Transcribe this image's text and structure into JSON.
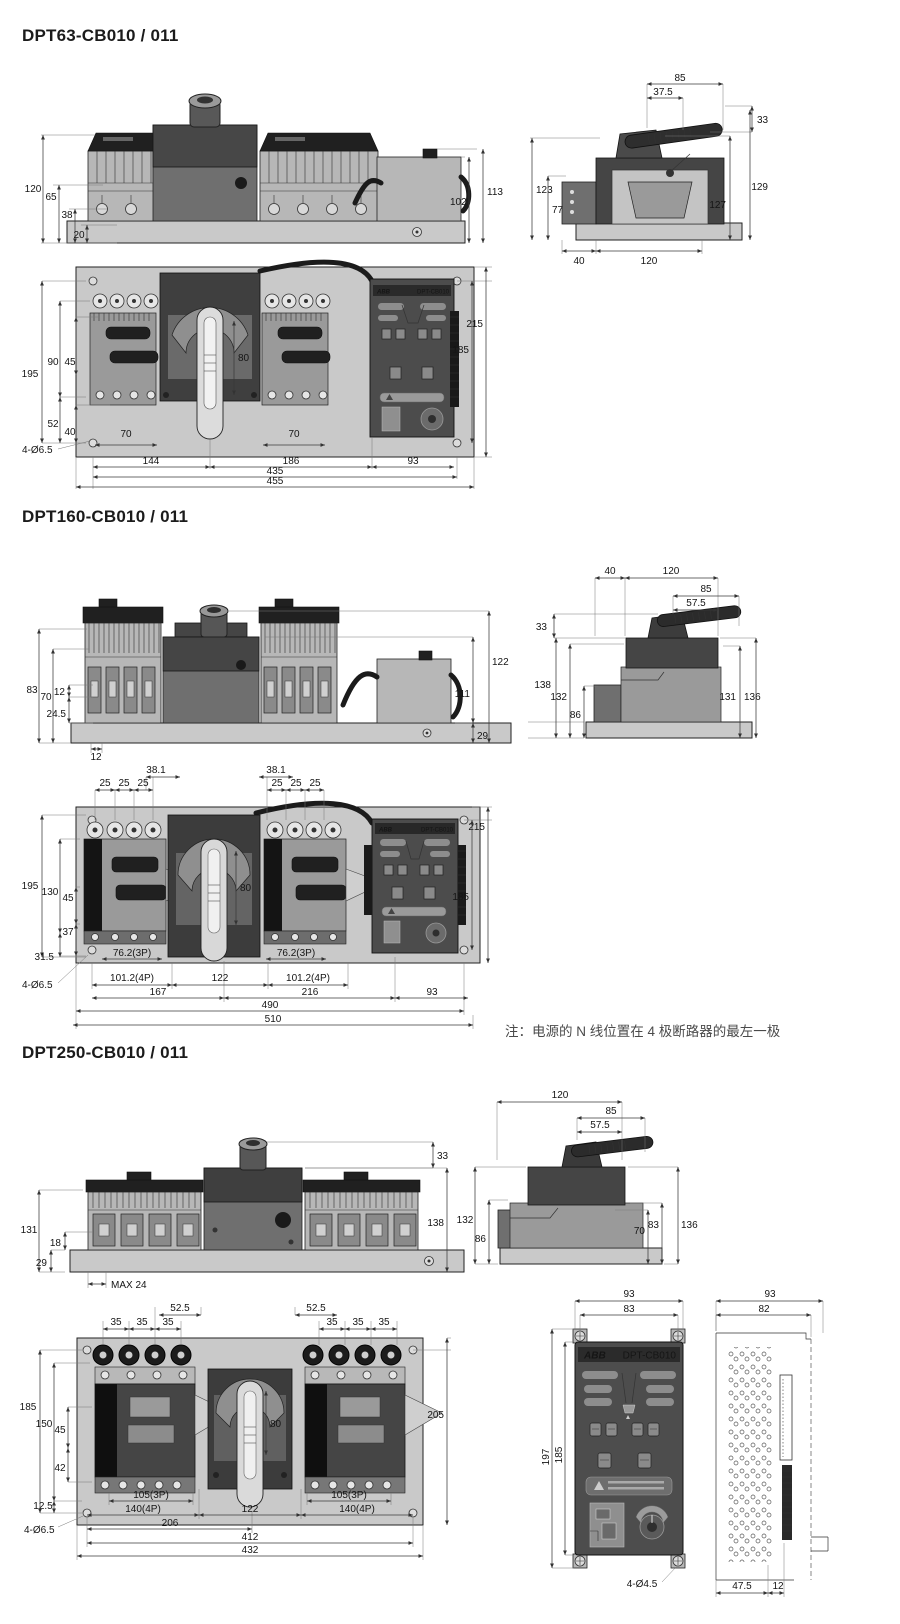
{
  "doc": {
    "note": "注：电源的 N 线位置在 4 极断路器的最左一极"
  },
  "controller": {
    "brand": "ABB",
    "model": "DPT-CB010"
  },
  "dpt63": {
    "title": "DPT63-CB010 / 011",
    "front": {
      "h120": "120",
      "h65": "65",
      "h38": "38",
      "h20": "20",
      "h113": "113",
      "h102": "102"
    },
    "side": {
      "w85": "85",
      "w37_5": "37.5",
      "h33": "33",
      "h123": "123",
      "h77": "77",
      "h127": "127",
      "h129": "129",
      "w40": "40",
      "w120": "120"
    },
    "plan": {
      "h195": "195",
      "h90": "90",
      "h45": "45",
      "h52": "52",
      "h40": "40",
      "c80": "80",
      "w70": "70",
      "w144": "144",
      "w186": "186",
      "w93": "93",
      "w435": "435",
      "w455": "455",
      "h215": "215",
      "h185": "185",
      "holes": "4-Ø6.5"
    }
  },
  "dpt160": {
    "title": "DPT160-CB010 / 011",
    "front": {
      "h83": "83",
      "h70": "70",
      "h12": "12",
      "h24_5": "24.5",
      "w12": "12",
      "h122": "122",
      "h111": "111",
      "h29": "29"
    },
    "side": {
      "w40": "40",
      "w120": "120",
      "w85": "85",
      "w57_5": "57.5",
      "h33": "33",
      "h138": "138",
      "h132": "132",
      "h86": "86",
      "h131": "131",
      "h136": "136"
    },
    "plan": {
      "w38_1": "38.1",
      "w25": "25",
      "h195": "195",
      "h130": "130",
      "h45": "45",
      "h37": "37",
      "h31_5": "31.5",
      "c80": "80",
      "w76_2": "76.2(3P)",
      "w101_2": "101.2(4P)",
      "w122": "122",
      "w167": "167",
      "w216": "216",
      "w93": "93",
      "w490": "490",
      "w510": "510",
      "h215": "215",
      "h185": "185",
      "holes": "4-Ø6.5"
    }
  },
  "dpt250": {
    "title": "DPT250-CB010 / 011",
    "front": {
      "h131": "131",
      "h18": "18",
      "h29": "29",
      "max24": "MAX 24",
      "h33": "33",
      "h138": "138"
    },
    "side": {
      "w120": "120",
      "w85": "85",
      "w57_5": "57.5",
      "h132": "132",
      "h86": "86",
      "h70": "70",
      "h83": "83",
      "h136": "136"
    },
    "plan": {
      "w52_5": "52.5",
      "w35": "35",
      "h185": "185",
      "h150": "150",
      "h45": "45",
      "h42": "42",
      "h12_5": "12.5",
      "h205": "205",
      "c80": "80",
      "w105": "105(3P)",
      "w140": "140(4P)",
      "w122": "122",
      "w206": "206",
      "w412": "412",
      "w432": "432",
      "holes": "4-Ø6.5"
    },
    "ctrl_front": {
      "w93": "93",
      "w83": "83",
      "h197": "197",
      "h185": "185",
      "holes": "4-Ø4.5"
    },
    "ctrl_side": {
      "w93": "93",
      "w82": "82",
      "w47_5": "47.5",
      "w12": "12"
    }
  }
}
